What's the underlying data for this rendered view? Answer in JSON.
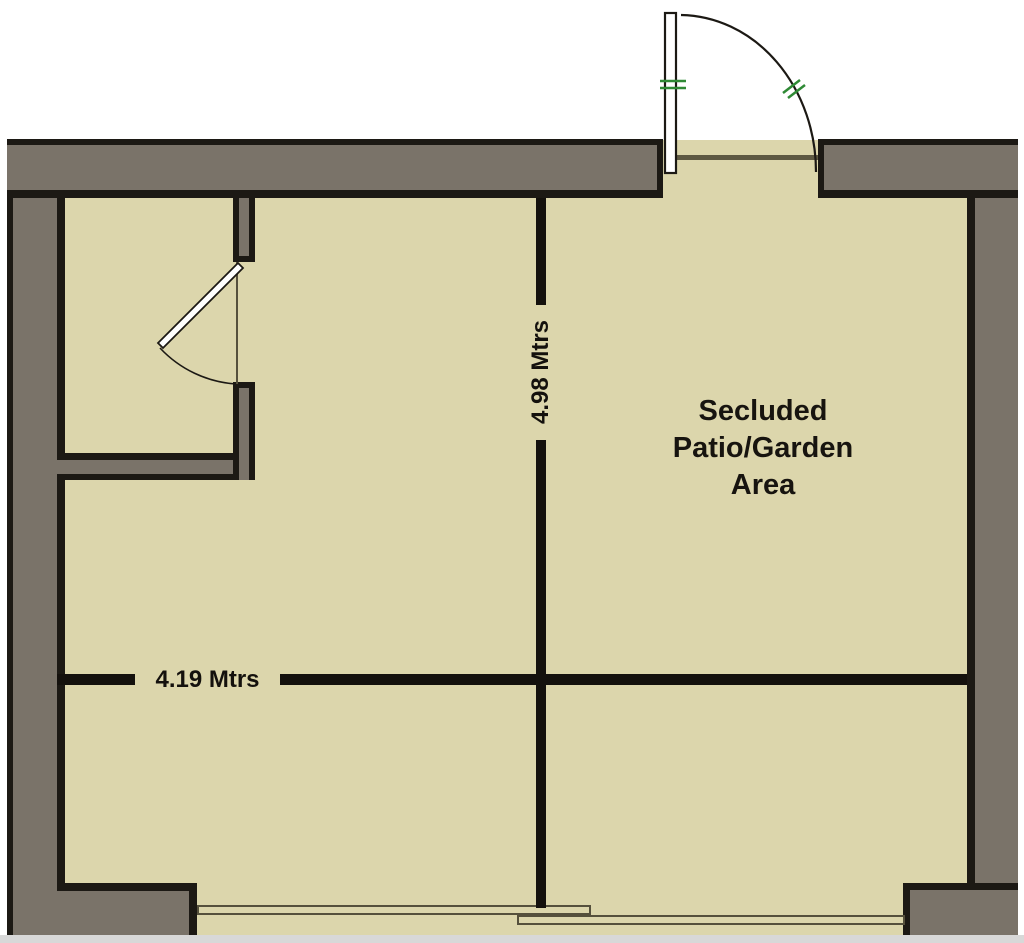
{
  "plan": {
    "area_label": {
      "line1": "Secluded",
      "line2": "Patio/Garden",
      "line3": "Area"
    },
    "dimensions": {
      "vertical": "4.98 Mtrs",
      "horizontal": "4.19 Mtrs"
    },
    "features": {
      "entrance_door": "hinged-door-with-quarter-swing-arc-top-wall",
      "interior_door": "hinged-door-with-swing-arc-inner-room",
      "sliding_panels": "two-overlapping-panels-bottom-wall"
    },
    "colors": {
      "background": "#ffffff",
      "wall": "#7a7369",
      "outline": "#1c1914",
      "floor": "#dcd6ac",
      "dimension": "#14110d",
      "window_frame": "#55503c",
      "threshold": "#5e5942",
      "tick_green": "#2f8a35",
      "edge_strip": "#d8d8d8"
    }
  }
}
